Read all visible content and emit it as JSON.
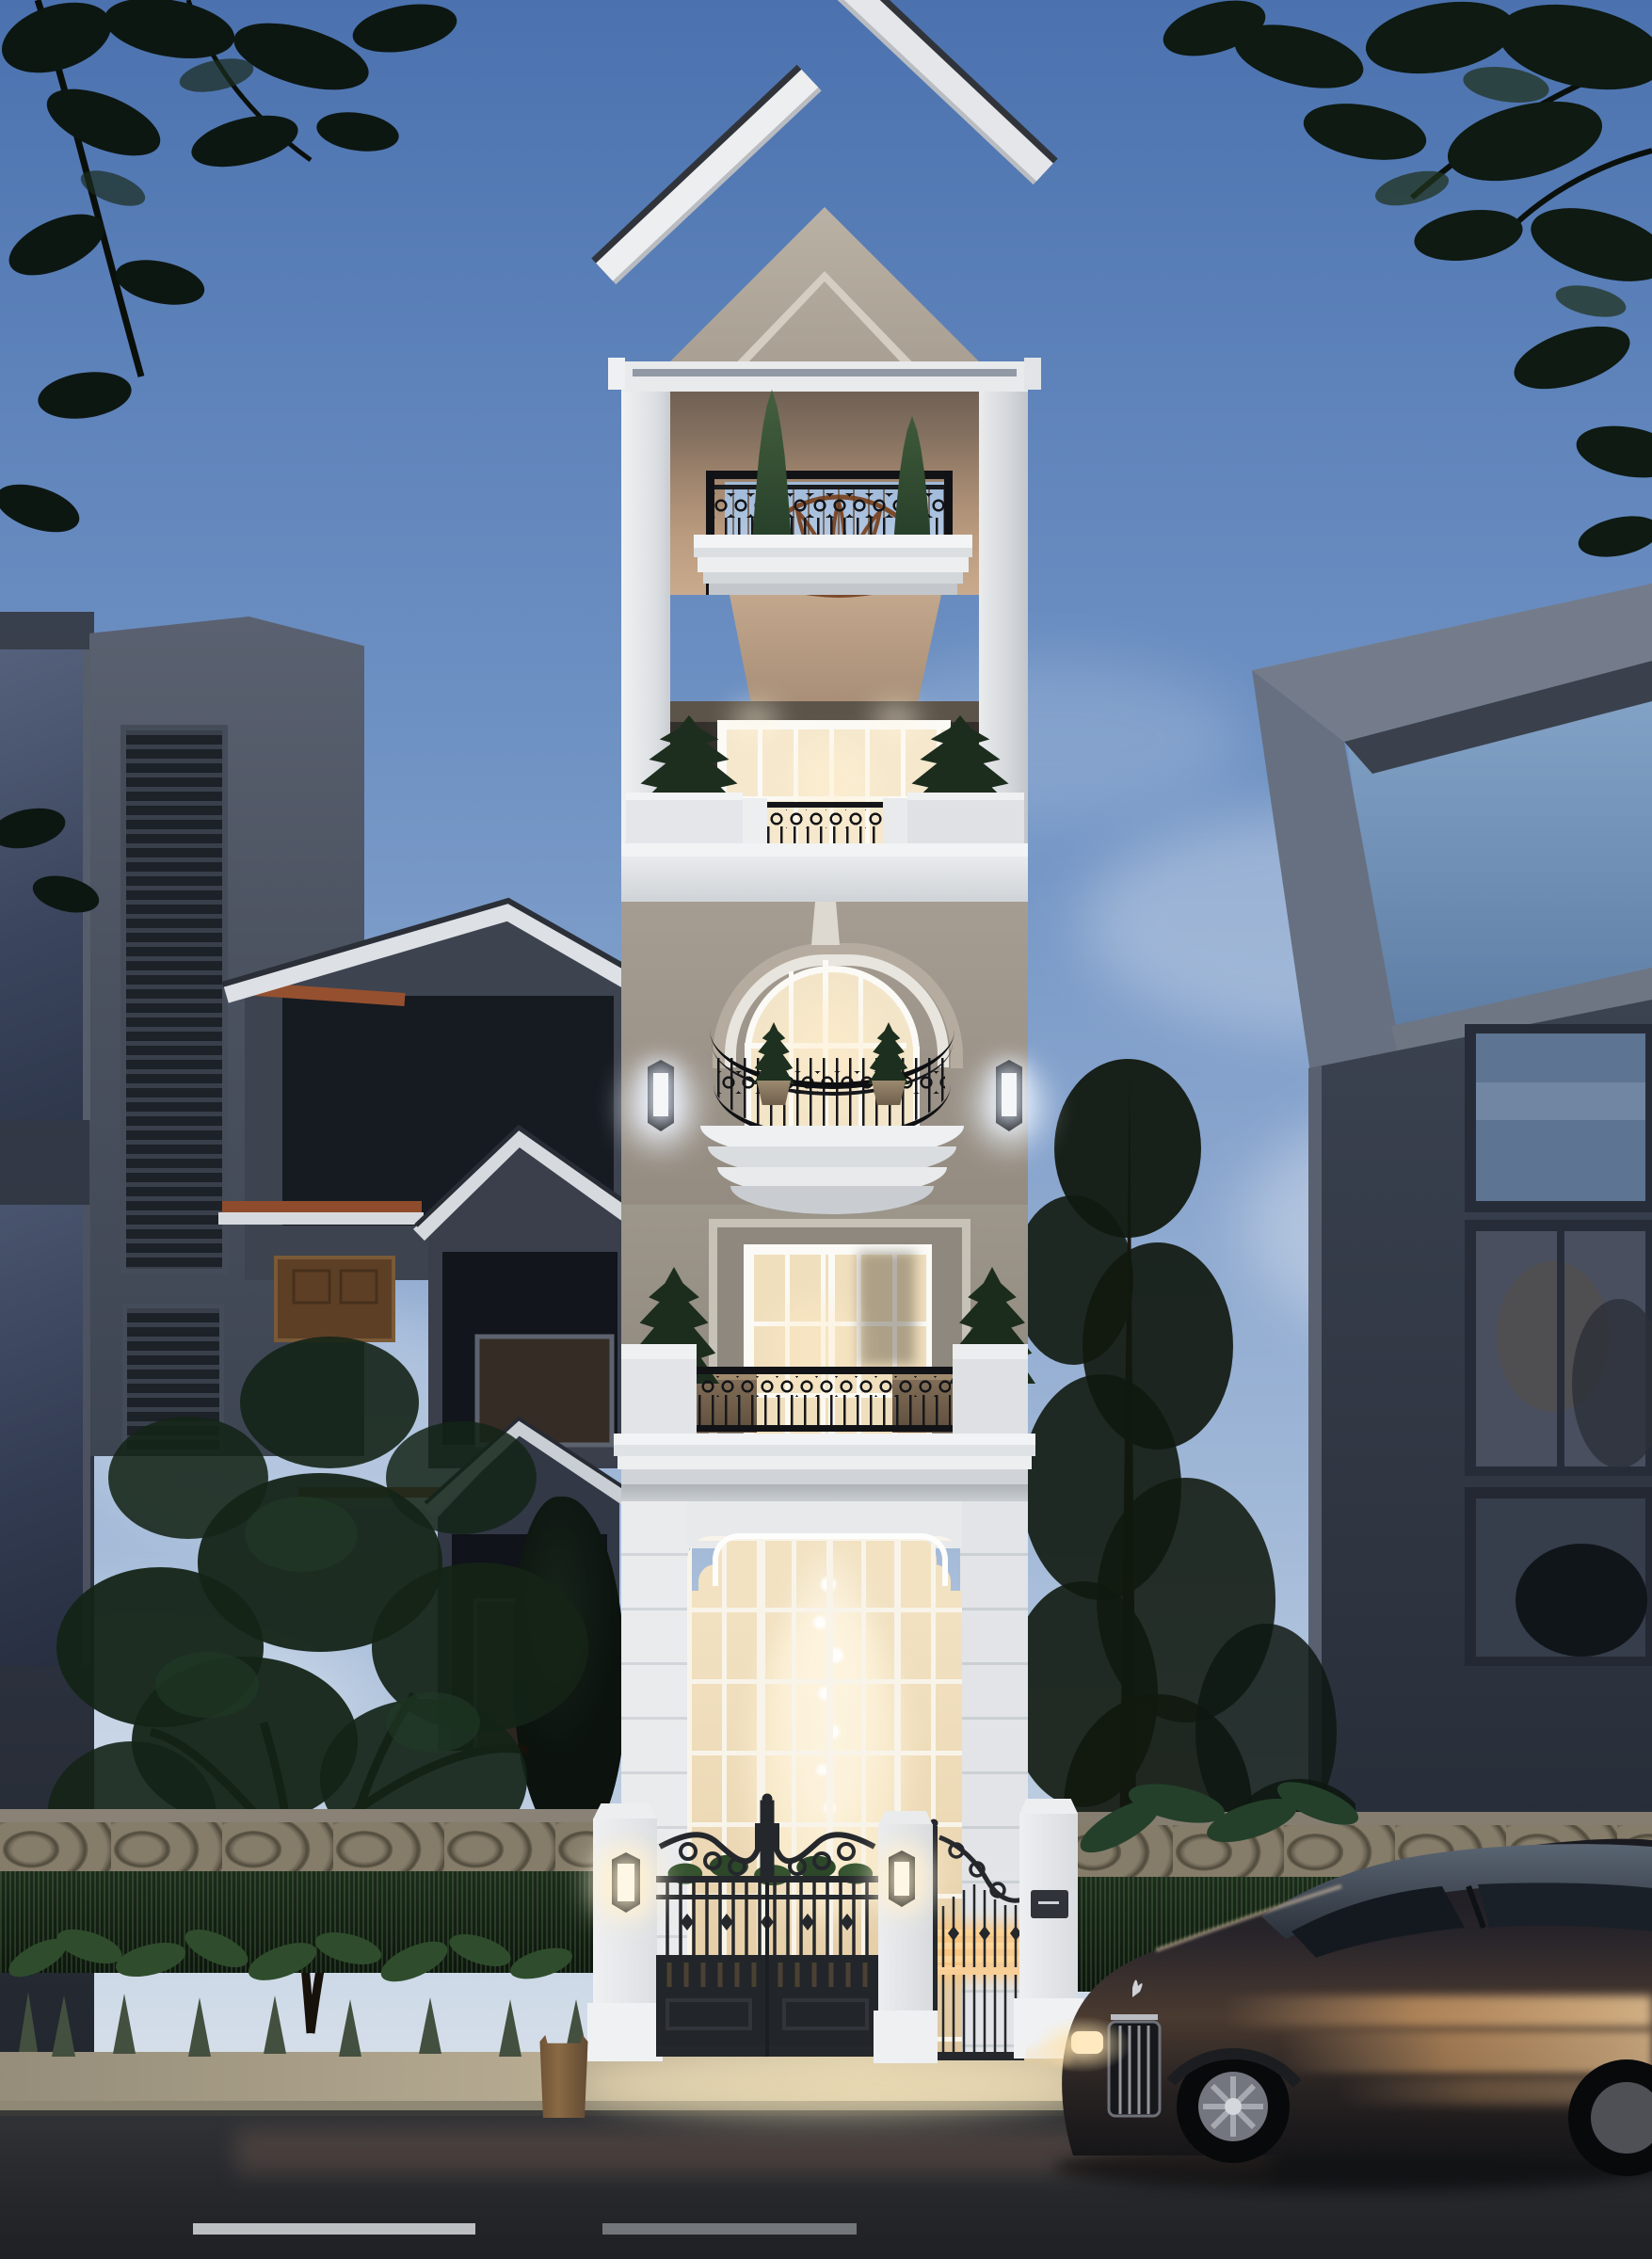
{
  "image": {
    "type": "architectural-rendering",
    "time_of_day": "dusk",
    "description": "Photorealistic dusk rendering of a narrow five-level neoclassical townhouse with lit interiors, ornate iron balconies and entry gates, flanked by a dark modern house on the left and a glass-front modern house on the right, with a dark luxury sedan passing on the street in the foreground"
  },
  "palette": {
    "sky_top": "#4b72af",
    "sky_horizon": "#dde4ec",
    "facade_white": "#eceef0",
    "pediment_beige": "#b7aea2",
    "balcony_back_tan": "#c9aa8c",
    "warm_window_light": "#f6e8cd",
    "ground_glass_glow": "#f2e2c2",
    "iron_black": "#1a1c1f",
    "fan_rust": "#7c4a2b",
    "terracotta_eave": "#95502f",
    "left_house_gray": "#4a5160",
    "right_house_gray": "#39404d",
    "foliage_dark": "#132016",
    "hedge_green": "#1c2b1d",
    "stone_wall": "#6e6656",
    "sidewalk": "#c4b89e",
    "road_asphalt": "#26282c",
    "car_body_dark": "#26242a",
    "car_reflection_warm": "#caa06a",
    "lantern_glow": "#fff3da",
    "gate_led_warm": "#ffd9a0"
  },
  "scene": {
    "tower": {
      "levels": [
        "gable pediment",
        "roof terrace with fan grille balcony",
        "loggia with french windows",
        "arched window with bow balcony",
        "french-door balcony",
        "double-height glass entry with chandelier"
      ],
      "balcony_trees": 4,
      "wall_lanterns": 2,
      "gate": {
        "pillars": 3,
        "pillar_lanterns": 2,
        "leaves": [
          "double vehicle gate",
          "pedestrian side gate with lit bars"
        ]
      }
    },
    "left_building": {
      "style": "dark modern villa",
      "gables": 3,
      "louver_panels": 2,
      "terracotta_eaves": 3
    },
    "right_building": {
      "style": "modern glass house",
      "roof_pergola": true,
      "glass_floors": 3
    },
    "street": {
      "lane_dashes": 2,
      "sidewalk": true,
      "stone_fence_with_hedge": true
    },
    "car": {
      "kind": "luxury sedan",
      "facing": "left",
      "visible_wheels": 2,
      "hood_ornament": true,
      "headlight_on": true
    }
  }
}
